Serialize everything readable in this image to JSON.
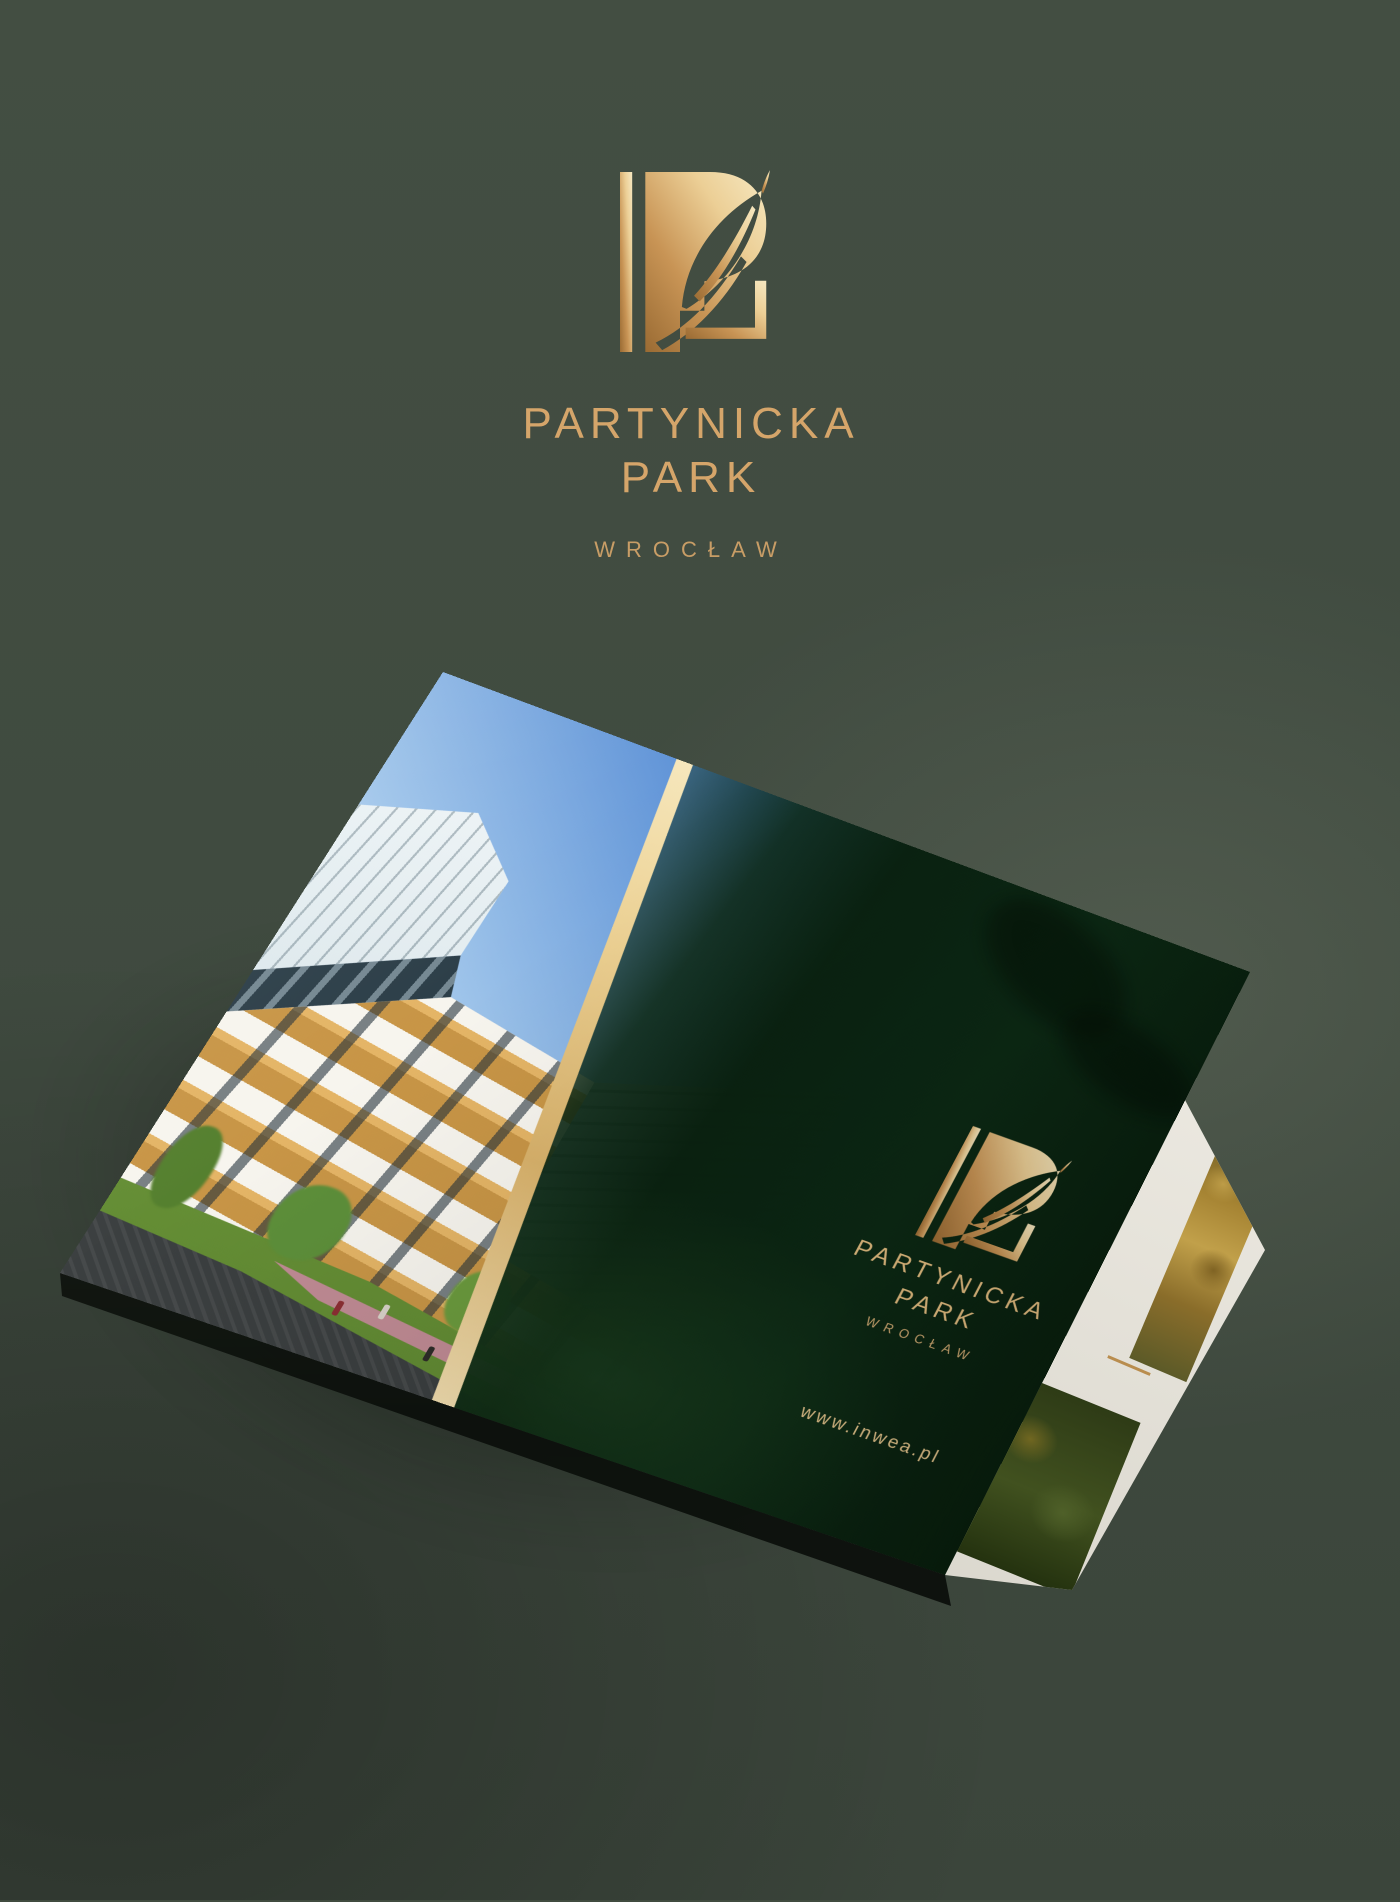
{
  "header": {
    "title_line1": "PARTYNICKA",
    "title_line2": "PARK",
    "city": "WROCŁAW"
  },
  "cover": {
    "title_line1": "PARTYNICKA",
    "title_line2": "PARK",
    "city": "WROCŁAW",
    "website": "www.inwea.pl"
  },
  "icons": {
    "monogram": "p-letter-with-leaf-monogram"
  },
  "colors": {
    "backdrop_green": "#404b3f",
    "gold_text": "#d5a56a",
    "gold_gradient_light": "#f6e8c1",
    "gold_gradient_dark": "#9a6b33",
    "cover_green_dark": "#0a2a12",
    "gold_stripe": "#eccf96",
    "sky_blue": "#3a78cc",
    "facade_wood": "#c6913e",
    "page_edge_white": "#f0eee7"
  }
}
